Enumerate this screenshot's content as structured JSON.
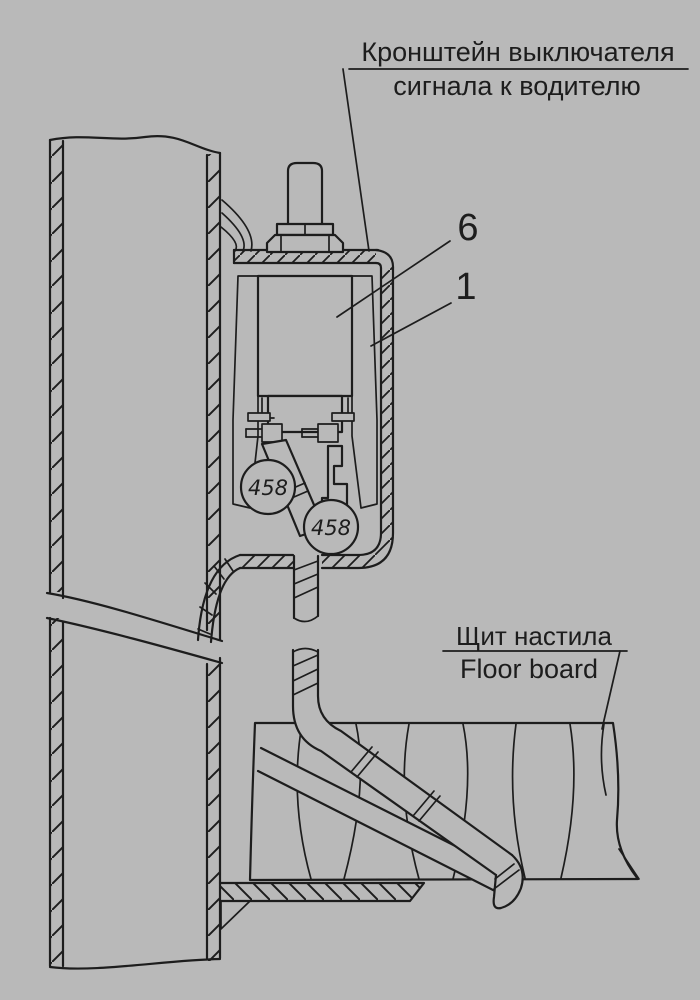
{
  "colors": {
    "background": "#b9b9b9",
    "ink": "#1d1d1d"
  },
  "labels": {
    "bracket_caption_line1": "Кронштейн выключателя",
    "bracket_caption_line2": "сигнала к водителю",
    "floor_caption_ru": "Щит настила",
    "floor_caption_en": "Floor board",
    "callout_6": "6",
    "callout_1": "1",
    "wire_tag_left": "458",
    "wire_tag_right": "458"
  }
}
